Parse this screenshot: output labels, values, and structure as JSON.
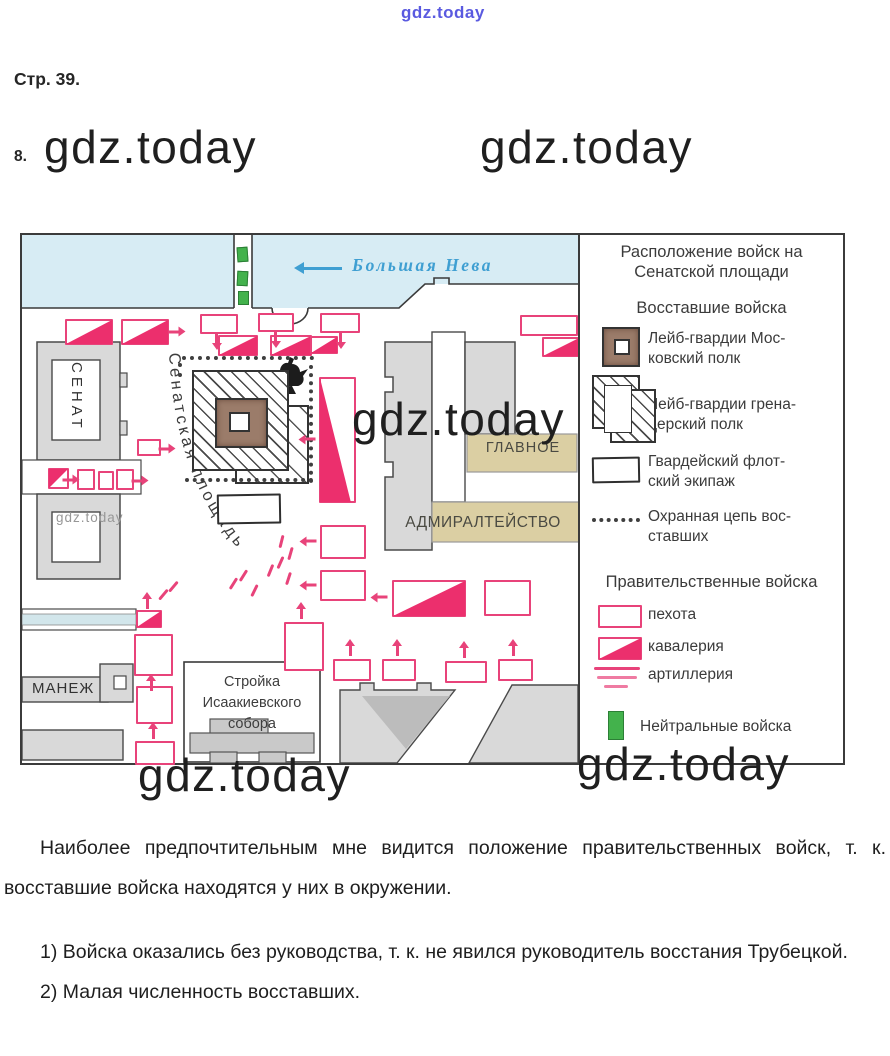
{
  "watermarks": {
    "top": "gdz.today",
    "heading_left": "gdz.today",
    "heading_right": "gdz.today",
    "map_center": "gdz.today",
    "map_small": "gdz.today",
    "bottom_left": "gdz.today",
    "bottom_right": "gdz.today"
  },
  "page": {
    "page_label": "Стр. 39.",
    "task_number": "8."
  },
  "map": {
    "river_label": "Большая Нева",
    "senate_label": "СЕНАТ",
    "square_label": "Сенатская площадь",
    "glavnoe_label": "ГЛАВНОЕ",
    "admiralty_label": "АДМИРАЛТЕЙСТВО",
    "manege_label": "МАНЕЖ",
    "construction_line1": "Стройка",
    "construction_line2": "Исаакиевского",
    "construction_line3": "собора"
  },
  "legend": {
    "title_line1": "Расположение войск на",
    "title_line2": "Сенатской площади",
    "rebels_header": "Восставшие войска",
    "rebel_items": [
      {
        "line1": "Лейб-гвардии Мос-",
        "line2": "ковский полк",
        "icon": "brown-square-white-center"
      },
      {
        "line1": "Лейб-гвардии грена-",
        "line2": "дерский полк",
        "icon": "overlapping-hatched-squares"
      },
      {
        "line1": "Гвардейский флот-",
        "line2": "ский экипаж",
        "icon": "white-rectangle"
      },
      {
        "line1": "Охранная цепь вос-",
        "line2": "ставших",
        "icon": "dotted-chain"
      }
    ],
    "government_header": "Правительственные войска",
    "government_items": [
      {
        "label": "пехота",
        "icon": "pink-rectangle"
      },
      {
        "label": "кавалерия",
        "icon": "pink-rectangle-filled-triangle"
      },
      {
        "label": "артиллерия",
        "icon": "pink-lines"
      }
    ],
    "neutral_item": {
      "label": "Нейтральные войска",
      "icon": "green-rectangle"
    }
  },
  "answer": {
    "paragraph": "Наиболее предпочтительным мне видится положение правительственных войск, т. к. восставшие войска находятся у них в окружении.",
    "item1": "1) Войска оказались без руководства, т. к. не явился руководитель восстания Трубецкой.",
    "item2": "2) Малая численность восставших."
  },
  "colors": {
    "troop_pink": "#e8437a",
    "troop_pink_fill": "#ec2f6d",
    "neutral_green": "#43b24c",
    "river_blue": "#d7ecf4",
    "river_text_blue": "#3f9fd2",
    "building_gray": "#d9d9d9",
    "label_tan": "#dbcfa3",
    "moscow_brown": "#9b7c6a"
  }
}
